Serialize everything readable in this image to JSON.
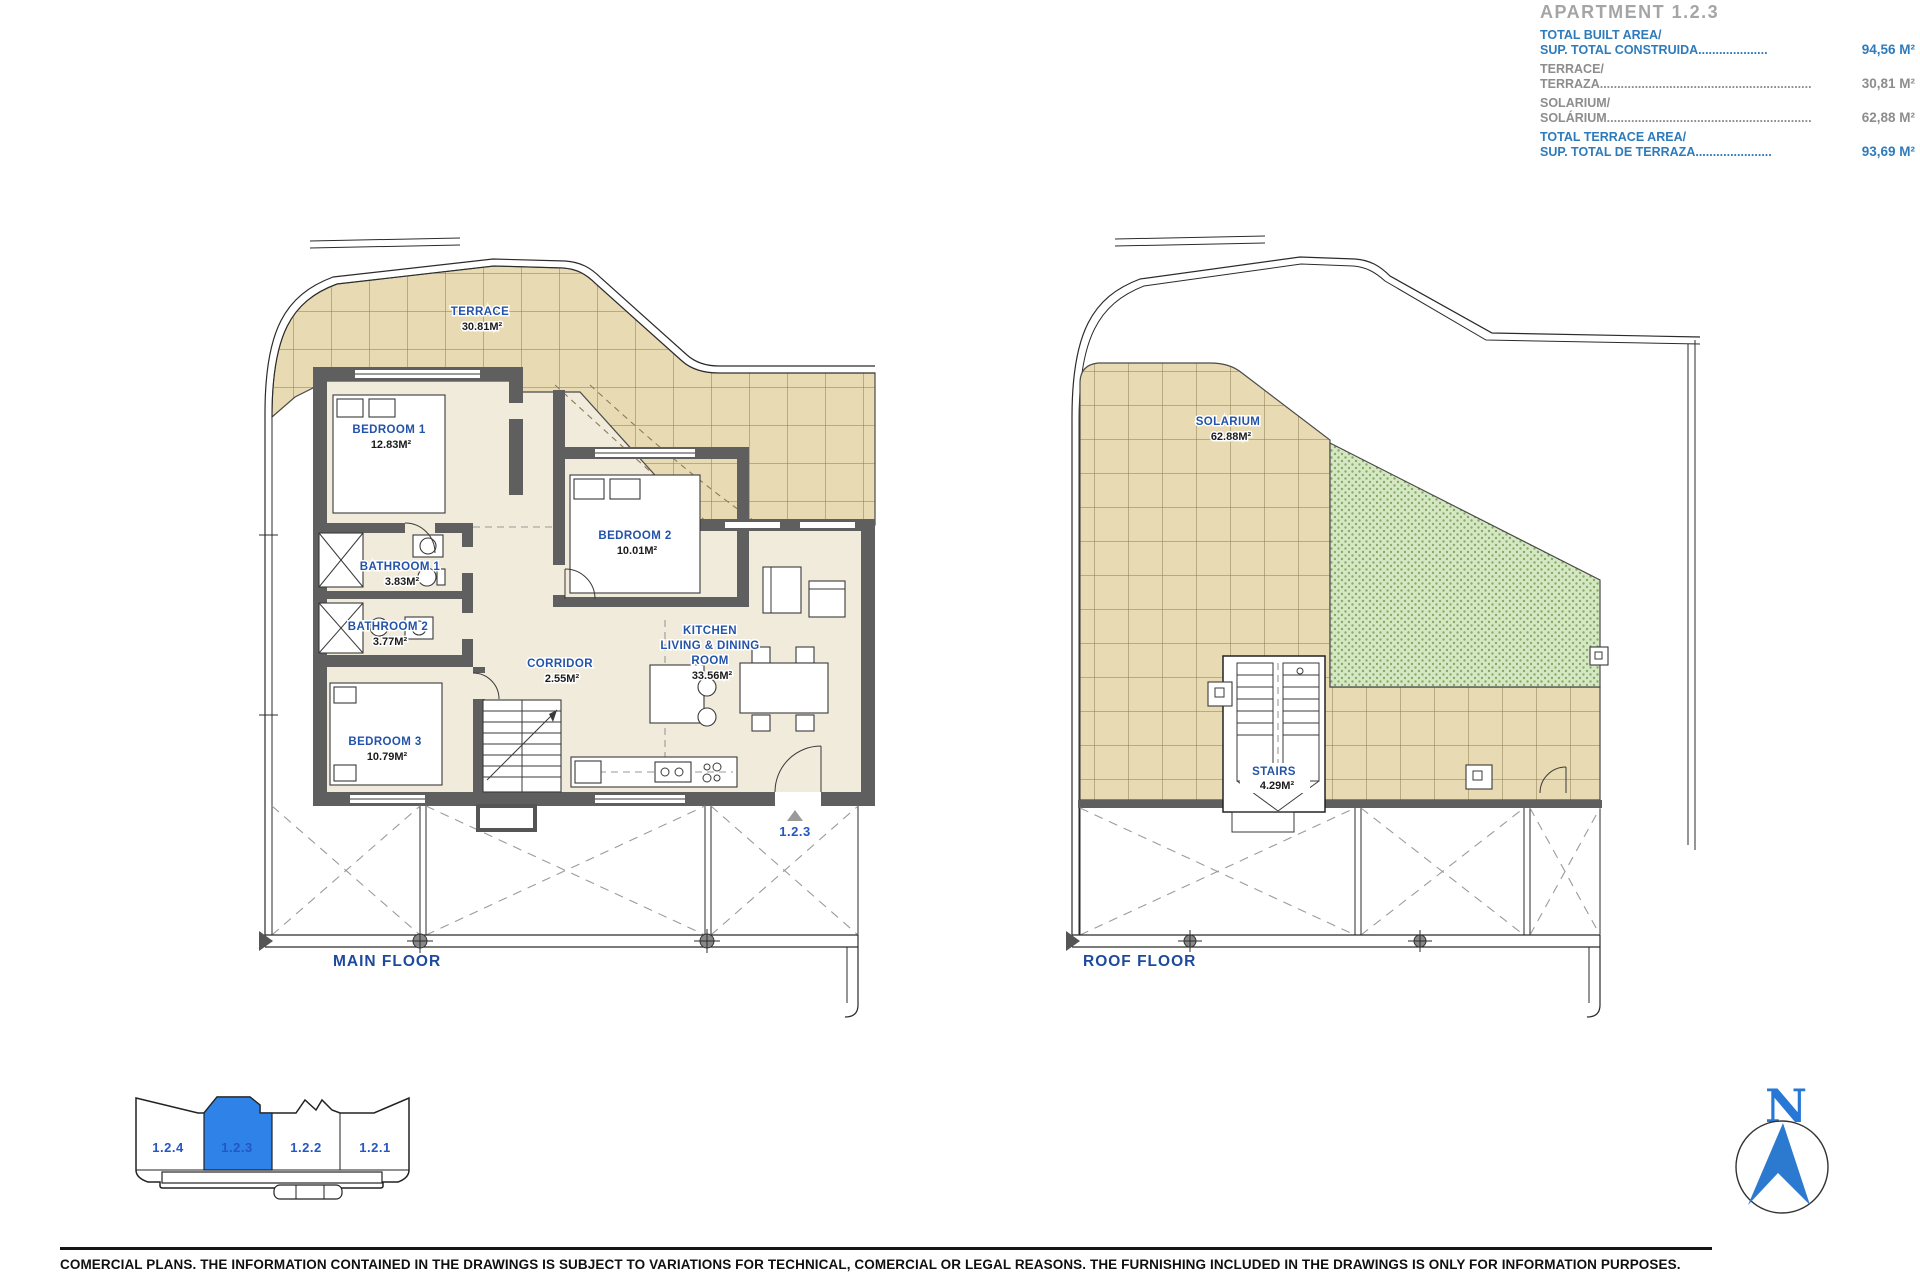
{
  "header": {
    "title": "APARTMENT 1.2.3",
    "rows": [
      {
        "line1": "TOTAL BUILT AREA/",
        "line2": "SUP. TOTAL CONSTRUIDA....................",
        "value": "94,56 M²"
      },
      {
        "line1": "TERRACE/",
        "line2": "TERRAZA.............................................................",
        "value": "30,81 M²"
      },
      {
        "line1": "SOLARIUM/",
        "line2": "SOLÁRIUM...........................................................",
        "value": "62,88 M²"
      },
      {
        "line1": "TOTAL TERRACE AREA/",
        "line2": "SUP. TOTAL DE TERRAZA......................",
        "value": "93,69 M²"
      }
    ]
  },
  "main_floor": {
    "title": "MAIN FLOOR",
    "marker": "1.2.3",
    "rooms": {
      "terrace": {
        "name": "TERRACE",
        "area": "30.81M²"
      },
      "bedroom1": {
        "name": "BEDROOM 1",
        "area": "12.83M²"
      },
      "bathroom1": {
        "name": "BATHROOM 1",
        "area": "3.83M²"
      },
      "bathroom2": {
        "name": "BATHROOM 2",
        "area": "3.77M²"
      },
      "bedroom3": {
        "name": "BEDROOM 3",
        "area": "10.79M²"
      },
      "corridor": {
        "name": "CORRIDOR",
        "area": "2.55M²"
      },
      "bedroom2": {
        "name": "BEDROOM 2",
        "area": "10.01M²"
      },
      "kitchen": {
        "line1": "KITCHEN",
        "line2": "LIVING & DINING",
        "line3": "ROOM",
        "area": "33.56M²"
      }
    }
  },
  "roof_floor": {
    "title": "ROOF FLOOR",
    "rooms": {
      "solarium": {
        "name": "SOLARIUM",
        "area": "62.88M²"
      },
      "stairs": {
        "name": "STAIRS",
        "area": "4.29M²"
      }
    }
  },
  "key_plan": {
    "units": [
      "1.2.4",
      "1.2.3",
      "1.2.2",
      "1.2.1"
    ],
    "selected": "1.2.3"
  },
  "compass": {
    "north": "N"
  },
  "footer": {
    "disclaimer": "COMERCIAL PLANS. THE INFORMATION CONTAINED IN THE DRAWINGS IS SUBJECT TO VARIATIONS FOR TECHNICAL, COMERCIAL OR LEGAL REASONS. THE FURNISHING INCLUDED IN THE DRAWINGS IS ONLY FOR INFORMATION PURPOSES."
  },
  "colors": {
    "accent_blue": "#2e7bbc",
    "label_blue": "#2353a8",
    "highlight_blue": "#2e82e8",
    "tile_tan": "#e8dab2",
    "grass_green": "#d6e7c4",
    "wall_gray": "#5f5f5f"
  }
}
